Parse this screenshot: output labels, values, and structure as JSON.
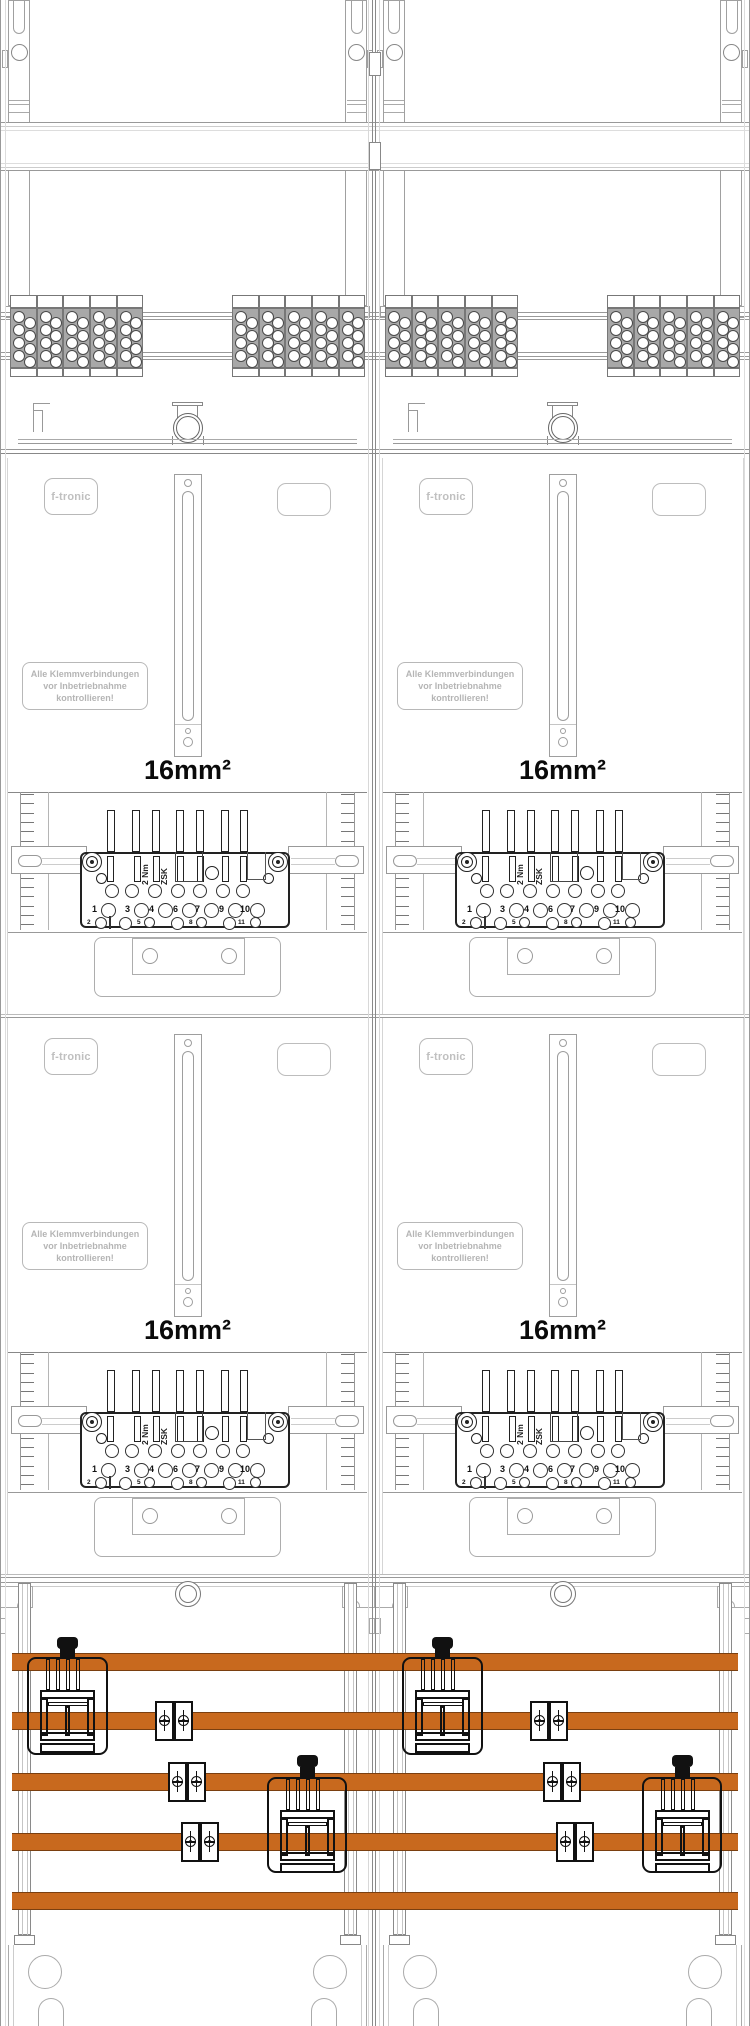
{
  "drawing": {
    "brand": "f-tronic",
    "warning": {
      "line1": "Alle Klemmverbindungen",
      "line2": "vor Inbetriebnahme",
      "line3": "kontrollieren!"
    },
    "wire_size_label": "16mm²",
    "terminal": {
      "type_label": "ZSK",
      "torque_label": "2 Nm",
      "row1_numbers": [
        "1",
        "3",
        "4",
        "6",
        "7",
        "9",
        "10"
      ],
      "row2_numbers": [
        "2",
        "5",
        "8",
        "11"
      ]
    },
    "colors": {
      "busbar_orange": "#C8691E",
      "outline_gray": "#9a9a9a",
      "device_black": "#111111"
    }
  }
}
